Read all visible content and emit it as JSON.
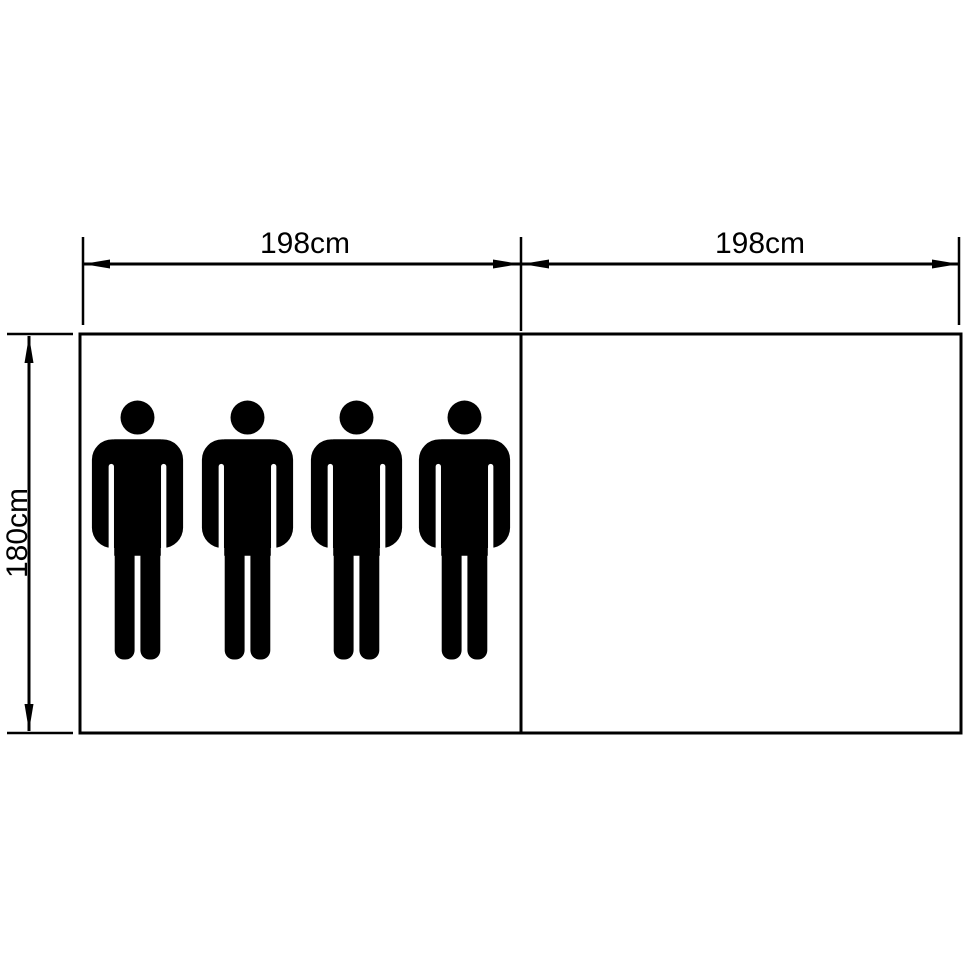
{
  "diagram": {
    "width_label_left": "198cm",
    "width_label_right": "198cm",
    "height_label": "180cm",
    "person_count": 4,
    "colors": {
      "line": "#000000",
      "background": "#ffffff",
      "figure": "#000000"
    },
    "sections": [
      {
        "name": "left-section",
        "width": "198cm",
        "height": "180cm",
        "persons": 4
      },
      {
        "name": "right-section",
        "width": "198cm",
        "height": "180cm",
        "persons": 0
      }
    ]
  }
}
